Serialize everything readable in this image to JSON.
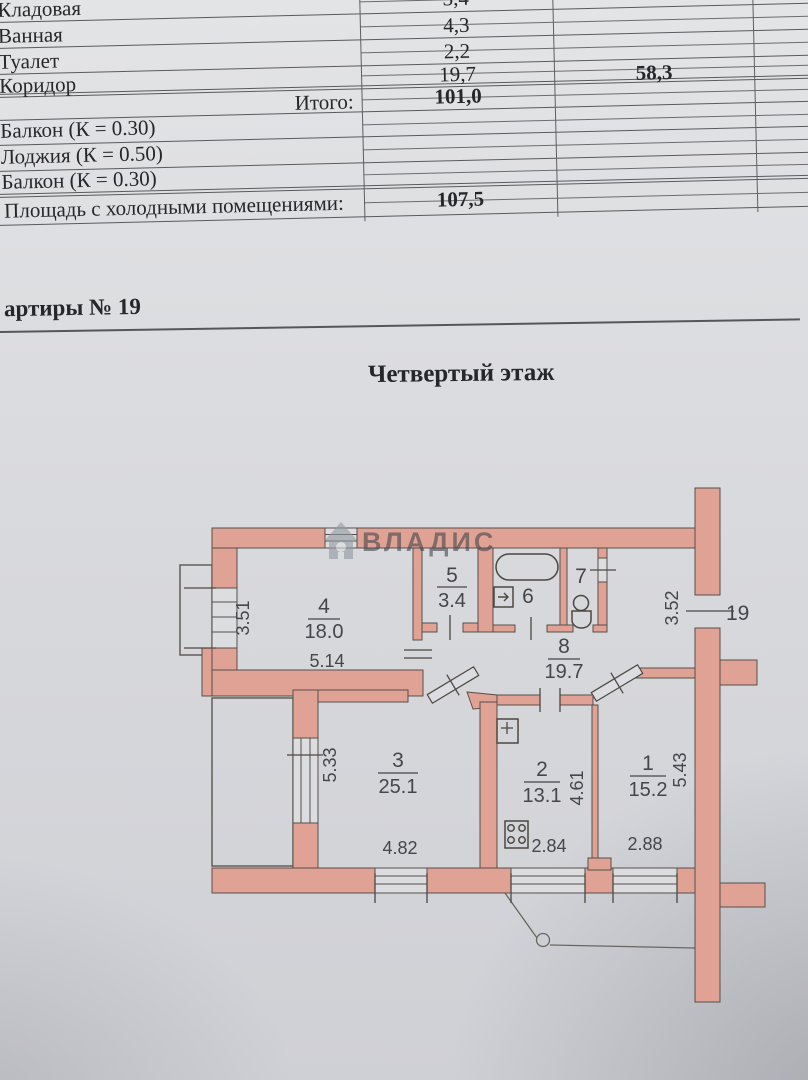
{
  "document": {
    "table": {
      "rows": [
        {
          "label": "Кладовая",
          "value": "3,4"
        },
        {
          "label": "Ванная",
          "value": "4,3"
        },
        {
          "label": "Туалет",
          "value": "2,2"
        },
        {
          "label": "Коридор",
          "value": "19,7"
        }
      ],
      "total_label": "Итого:",
      "total_value": "101,0",
      "secondary_total": "58,3",
      "cold_rows": [
        {
          "label": "Балкон (К = 0.30)"
        },
        {
          "label": "Лоджия (К = 0.50)"
        },
        {
          "label": "Балкон (К = 0.30)"
        }
      ],
      "cold_total_label": "Площадь с холодными помещениями:",
      "cold_total_value": "107,5"
    },
    "apartment_line": "артиры № 19",
    "floor_title": "Четвертый этаж"
  },
  "plan": {
    "watermark": "ВЛАДИС",
    "entrance_label": "19",
    "rooms": {
      "r1": {
        "number": "1",
        "area": "15.2"
      },
      "r2": {
        "number": "2",
        "area": "13.1"
      },
      "r3": {
        "number": "3",
        "area": "25.1"
      },
      "r4": {
        "number": "4",
        "area": "18.0"
      },
      "r5": {
        "number": "5",
        "area": "3.4"
      },
      "r6": {
        "number": "6"
      },
      "r7": {
        "number": "7"
      },
      "r8": {
        "number": "8",
        "area": "19.7"
      }
    },
    "dimensions": {
      "balcony4_height": "3.51",
      "room4_width": "5.14",
      "entry_height": "3.52",
      "room3_left": "5.33",
      "room2_right": "4.61",
      "room1_right": "5.43",
      "room3_bottom": "4.82",
      "room2_bottom": "2.84",
      "room1_bottom": "2.88"
    },
    "colors": {
      "wall": "#e0a294",
      "entrance_red": "#b3566a"
    }
  }
}
